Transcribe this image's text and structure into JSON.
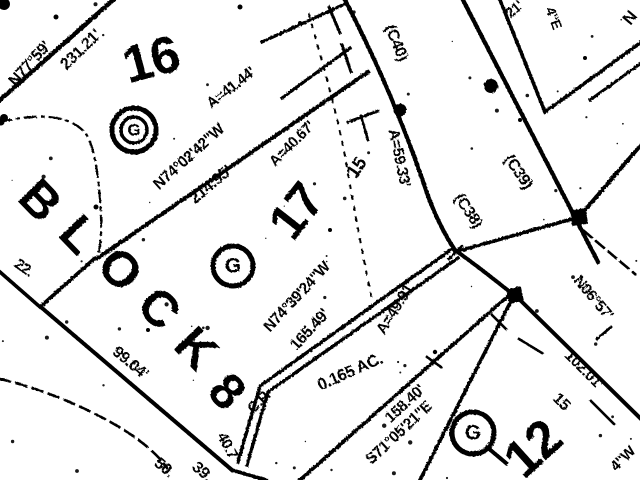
{
  "map": {
    "description_colors": {
      "ink": "#000000",
      "paper": "#ffffff"
    },
    "block_label": "BLOCK 8",
    "lot_numbers": [
      "16",
      "17",
      "12"
    ],
    "curve_references": [
      "(C40)",
      "(C38)",
      "(C39)"
    ],
    "area_label": "0.165 AC.",
    "labels": [
      {
        "id": "bearing-n77-59",
        "text": "N77°59'",
        "x": 30,
        "y": 64,
        "rot": -48,
        "size": 16
      },
      {
        "id": "dist-231-21",
        "text": "231.21'",
        "x": 81,
        "y": 50,
        "rot": -44,
        "size": 16
      },
      {
        "id": "arc-41-44",
        "text": "A=41.44'",
        "x": 231,
        "y": 88,
        "rot": -38,
        "size": 15
      },
      {
        "id": "bearing-n74-02-42",
        "text": "N74°02'42\"W",
        "x": 189,
        "y": 157,
        "rot": -42,
        "size": 15.5
      },
      {
        "id": "dist-214-95",
        "text": "214.95'",
        "x": 211,
        "y": 185,
        "rot": -40,
        "size": 16
      },
      {
        "id": "arc-40-67",
        "text": "A=40.67'",
        "x": 292,
        "y": 144,
        "rot": -45,
        "size": 15
      },
      {
        "id": "curve-c40",
        "text": "(C40)",
        "x": 396,
        "y": 43,
        "rot": 68,
        "size": 16
      },
      {
        "id": "arc-59-33",
        "text": "A=59.33'",
        "x": 399,
        "y": 158,
        "rot": 78,
        "size": 15.5
      },
      {
        "id": "curve-c38",
        "text": "(C38)",
        "x": 468,
        "y": 211,
        "rot": 56,
        "size": 16
      },
      {
        "id": "curve-c39",
        "text": "(C39)",
        "x": 518,
        "y": 172,
        "rot": 55,
        "size": 16
      },
      {
        "id": "tick-15-upper",
        "text": "15",
        "x": 357,
        "y": 168,
        "rot": -55,
        "size": 19
      },
      {
        "id": "bearing-n74-39-24",
        "text": "N74°39'24\"W",
        "x": 297,
        "y": 297,
        "rot": -47,
        "size": 15.5
      },
      {
        "id": "dist-165-49",
        "text": "165.49'",
        "x": 310,
        "y": 330,
        "rot": -47,
        "size": 16
      },
      {
        "id": "arc-49-91",
        "text": "A=49.91'",
        "x": 396,
        "y": 308,
        "rot": -58,
        "size": 15.5
      },
      {
        "id": "label-cp",
        "text": "C.P.",
        "x": 259,
        "y": 402,
        "rot": -45,
        "size": 15
      },
      {
        "id": "area-0165-ac",
        "text": "0.165 AC.",
        "x": 350,
        "y": 372,
        "rot": -24,
        "size": 16.5
      },
      {
        "id": "dist-158-40",
        "text": "158.40'",
        "x": 405,
        "y": 404,
        "rot": -43,
        "size": 15.5
      },
      {
        "id": "bearing-s71-05-21",
        "text": "S71°05'21\"E",
        "x": 399,
        "y": 433,
        "rot": -43,
        "size": 15.5
      },
      {
        "id": "dist-40-7",
        "text": "40.7'",
        "x": 228,
        "y": 447,
        "rot": 62,
        "size": 15
      },
      {
        "id": "dist-99-04",
        "text": "99.04'",
        "x": 130,
        "y": 363,
        "rot": 40,
        "size": 16
      },
      {
        "id": "frag-50",
        "text": "50.",
        "x": 164,
        "y": 468,
        "rot": 40,
        "size": 16
      },
      {
        "id": "frag-39",
        "text": "39.",
        "x": 202,
        "y": 472,
        "rot": 40,
        "size": 16
      },
      {
        "id": "frag-22",
        "text": "22.",
        "x": 24,
        "y": 268,
        "rot": 35,
        "size": 15
      },
      {
        "id": "dist-102-01",
        "text": "102.01'",
        "x": 584,
        "y": 370,
        "rot": 45,
        "size": 15.5
      },
      {
        "id": "bearing-n06-57",
        "text": "N06°57'",
        "x": 593,
        "y": 298,
        "rot": 50,
        "size": 15.5
      },
      {
        "id": "tick-15-lower",
        "text": "15",
        "x": 561,
        "y": 402,
        "rot": 45,
        "size": 16
      },
      {
        "id": "frag-4w",
        "text": "4\"W",
        "x": 623,
        "y": 459,
        "rot": -45,
        "size": 15
      },
      {
        "id": "frag-21",
        "text": "21'",
        "x": 514,
        "y": 9,
        "rot": -40,
        "size": 14
      },
      {
        "id": "frag-4e",
        "text": "4\"E",
        "x": 554,
        "y": 18,
        "rot": 70,
        "size": 14
      },
      {
        "id": "frag-n",
        "text": "N",
        "x": 630,
        "y": 18,
        "rot": -50,
        "size": 17
      },
      {
        "id": "lot-number-16",
        "text": "16",
        "x": 151,
        "y": 60,
        "rot": -15,
        "size": 52,
        "cls": "lot"
      },
      {
        "id": "lot-number-17",
        "text": "17",
        "x": 296,
        "y": 211,
        "rot": -52,
        "size": 50,
        "cls": "lot"
      },
      {
        "id": "lot-number-12",
        "text": "12",
        "x": 533,
        "y": 449,
        "rot": -42,
        "size": 52,
        "cls": "lot"
      },
      {
        "id": "block-letter-b",
        "text": "B",
        "x": 40,
        "y": 200,
        "rot": 46,
        "size": 50,
        "cls": "lot"
      },
      {
        "id": "block-letter-l",
        "text": "L",
        "x": 79,
        "y": 234,
        "rot": 46,
        "size": 50,
        "cls": "lot"
      },
      {
        "id": "block-letter-o",
        "text": "O",
        "x": 120,
        "y": 269,
        "rot": 46,
        "size": 50,
        "cls": "lot"
      },
      {
        "id": "block-letter-c",
        "text": "C",
        "x": 159,
        "y": 308,
        "rot": 46,
        "size": 50,
        "cls": "lot"
      },
      {
        "id": "block-letter-k",
        "text": "K",
        "x": 196,
        "y": 348,
        "rot": 46,
        "size": 50,
        "cls": "lot"
      },
      {
        "id": "block-letter-8",
        "text": "8",
        "x": 227,
        "y": 391,
        "rot": 46,
        "size": 50,
        "cls": "lot"
      }
    ],
    "g_symbols": [
      {
        "id": "g-marker-lot16",
        "letter": "G",
        "x": 134,
        "y": 130,
        "r_out": 22,
        "r_in": 13,
        "double": true,
        "tail": false
      },
      {
        "id": "g-marker-lot17",
        "letter": "G",
        "x": 233,
        "y": 266,
        "r_out": 20,
        "r_in": 0,
        "double": false,
        "tail": false
      },
      {
        "id": "g-marker-lot12",
        "letter": "G",
        "x": 473,
        "y": 433,
        "r_out": 21,
        "r_in": 0,
        "double": false,
        "tail": true
      }
    ],
    "monuments": {
      "dots": [
        {
          "x": 400,
          "y": 110,
          "r": 6.5
        },
        {
          "x": 491,
          "y": 86,
          "r": 7
        }
      ],
      "squares": [
        {
          "x": 579,
          "y": 217,
          "s": 16,
          "rot": -8
        },
        {
          "x": 515,
          "y": 295,
          "s": 15,
          "rot": -12
        }
      ]
    }
  }
}
